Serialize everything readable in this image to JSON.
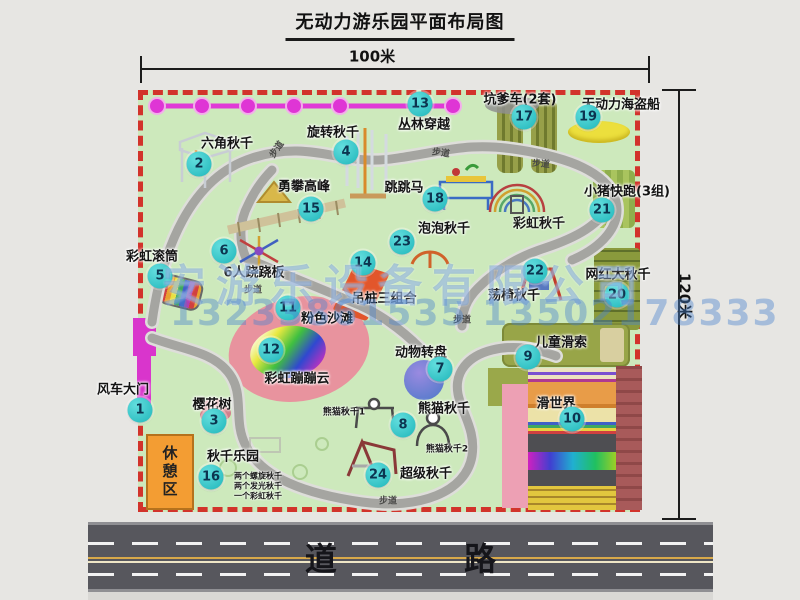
{
  "title": "无动力游乐园平面布局图",
  "dimension_top": "100米",
  "dimension_right": "120米",
  "road": {
    "label": "道 路"
  },
  "watermark": {
    "company": "安游乐设备有限公司",
    "phone": "13233861535 13502178333"
  },
  "rest_area": "休憩区",
  "colors": {
    "map_green": "#cde9bc",
    "border_red": "#d2332b",
    "badge_teal": "#1fb6ba",
    "gate_magenta": "#d935cc",
    "road_gray": "#57575d",
    "watermark_blue": "#4a82cc",
    "rest_orange": "#f39d33",
    "beach_pink": "#e8939e"
  },
  "attractions": [
    {
      "num": "1",
      "name": "风车大门",
      "bx": 140,
      "by": 410,
      "lx": 123,
      "ly": 388
    },
    {
      "num": "2",
      "name": "六角秋千",
      "bx": 199,
      "by": 164,
      "lx": 227,
      "ly": 142
    },
    {
      "num": "3",
      "name": "樱花树",
      "bx": 214,
      "by": 421,
      "lx": 212,
      "ly": 403
    },
    {
      "num": "4",
      "name": "旋转秋千",
      "bx": 346,
      "by": 152,
      "lx": 333,
      "ly": 131
    },
    {
      "num": "5",
      "name": "彩虹滚筒",
      "bx": 160,
      "by": 276,
      "lx": 152,
      "ly": 255
    },
    {
      "num": "6",
      "name": "6人跷跷板",
      "bx": 224,
      "by": 251,
      "lx": 254,
      "ly": 271
    },
    {
      "num": "7",
      "name": "动物转盘",
      "bx": 440,
      "by": 369,
      "lx": 421,
      "ly": 351
    },
    {
      "num": "8",
      "name": "熊猫秋千",
      "bx": 403,
      "by": 425,
      "lx": 444,
      "ly": 407
    },
    {
      "num": "9",
      "name": "儿童滑索",
      "bx": 528,
      "by": 357,
      "lx": 561,
      "ly": 341
    },
    {
      "num": "10",
      "name": "滑世界",
      "bx": 572,
      "by": 419,
      "lx": 556,
      "ly": 402
    },
    {
      "num": "11",
      "name": "粉色沙滩",
      "bx": 288,
      "by": 308,
      "lx": 327,
      "ly": 317
    },
    {
      "num": "12",
      "name": "彩虹蹦蹦云",
      "bx": 271,
      "by": 350,
      "lx": 297,
      "ly": 377
    },
    {
      "num": "13",
      "name": "丛林穿越",
      "bx": 420,
      "by": 104,
      "lx": 424,
      "ly": 123
    },
    {
      "num": "14",
      "name": "吊桩三组合",
      "bx": 363,
      "by": 263,
      "lx": 384,
      "ly": 297
    },
    {
      "num": "15",
      "name": "勇攀高峰",
      "bx": 311,
      "by": 209,
      "lx": 304,
      "ly": 185
    },
    {
      "num": "16",
      "name": "秋千乐园",
      "bx": 211,
      "by": 477,
      "lx": 233,
      "ly": 455
    },
    {
      "num": "17",
      "name": "坑爹车(2套)",
      "bx": 524,
      "by": 117,
      "lx": 520,
      "ly": 98
    },
    {
      "num": "18",
      "name": "跳跳马",
      "bx": 435,
      "by": 199,
      "lx": 404,
      "ly": 186
    },
    {
      "num": "19",
      "name": "无动力海盗船",
      "bx": 588,
      "by": 117,
      "lx": 621,
      "ly": 103
    },
    {
      "num": "20",
      "name": "网红大秋千",
      "bx": 617,
      "by": 295,
      "lx": 618,
      "ly": 273
    },
    {
      "num": "21",
      "name": "小猪快跑(3组)",
      "bx": 602,
      "by": 210,
      "lx": 627,
      "ly": 190
    },
    {
      "num": "22",
      "name": "荡椅秋千",
      "bx": 535,
      "by": 271,
      "lx": 514,
      "ly": 294
    },
    {
      "num": "23",
      "name": "泡泡秋千",
      "bx": 402,
      "by": 242,
      "lx": 444,
      "ly": 227
    },
    {
      "num": "24",
      "name": "超级秋千",
      "bx": 378,
      "by": 475,
      "lx": 426,
      "ly": 472
    }
  ],
  "extra_labels": [
    {
      "text": "彩虹秋千",
      "x": 539,
      "y": 222,
      "size": 13
    },
    {
      "text": "熊猫秋千1",
      "x": 344,
      "y": 411,
      "size": 9
    },
    {
      "text": "熊猫秋千2",
      "x": 447,
      "y": 448,
      "size": 9
    },
    {
      "text": "两个螺旋秋千",
      "x": 258,
      "y": 476,
      "size": 8
    },
    {
      "text": "两个发光秋千",
      "x": 258,
      "y": 486,
      "size": 8
    },
    {
      "text": "一个彩虹秋千",
      "x": 258,
      "y": 496,
      "size": 8
    }
  ],
  "path_label_text": "步道",
  "path_label_positions": [
    {
      "x": 276,
      "y": 149,
      "rot": -55
    },
    {
      "x": 441,
      "y": 152,
      "rot": 8
    },
    {
      "x": 541,
      "y": 163,
      "rot": 5
    },
    {
      "x": 253,
      "y": 289,
      "rot": 0
    },
    {
      "x": 462,
      "y": 319,
      "rot": 0
    },
    {
      "x": 388,
      "y": 500,
      "rot": 0
    }
  ]
}
